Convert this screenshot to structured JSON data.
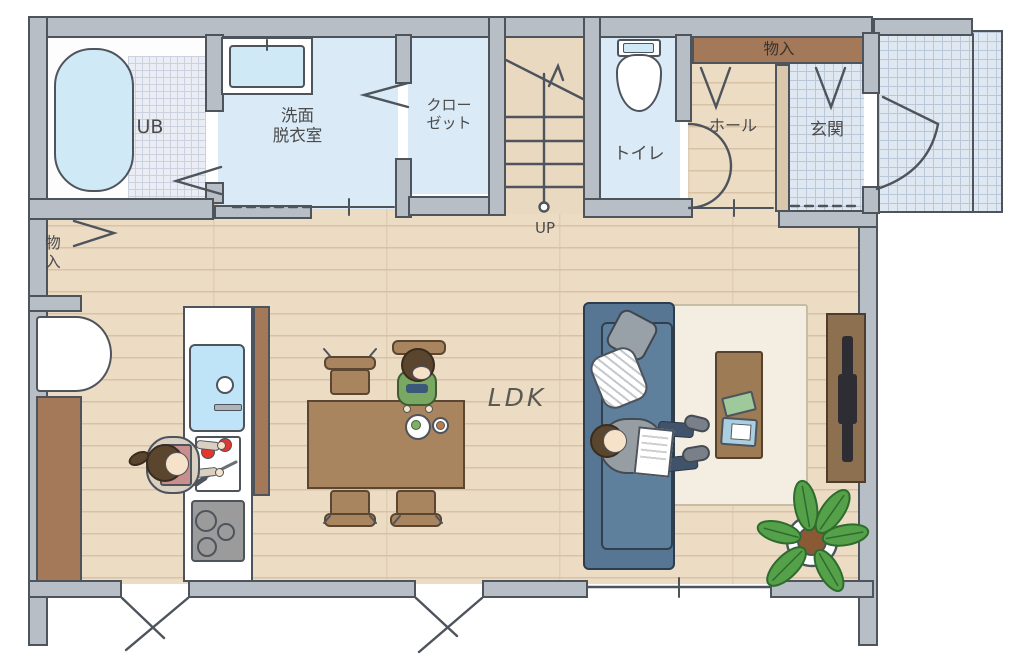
{
  "plan": {
    "rooms": {
      "ub": "UB",
      "washroom": "洗面\n脱衣室",
      "closet": "クロー\nゼット",
      "toilet": "トイレ",
      "hall": "ホール",
      "entrance": "玄関",
      "hall_storage": "物入",
      "ldk_storage": "物\n入",
      "ldk": "LDK",
      "stairs_up": "UP"
    },
    "colors": {
      "wall_gray": "#b7bec6",
      "outline": "#4e545c",
      "wood_floor": "#ecdcc4",
      "wet_room_floor": "#daeaf7",
      "tile_floor": "#dfe7f1",
      "storage_brown": "#a3795a",
      "furniture_brown": "#a8855e",
      "sofa_blue": "#567694",
      "rug_cream": "#f3eee1",
      "plant_green": "#55a149",
      "tomato_red": "#e3372e",
      "bath_blue": "#cfe9f6"
    }
  }
}
